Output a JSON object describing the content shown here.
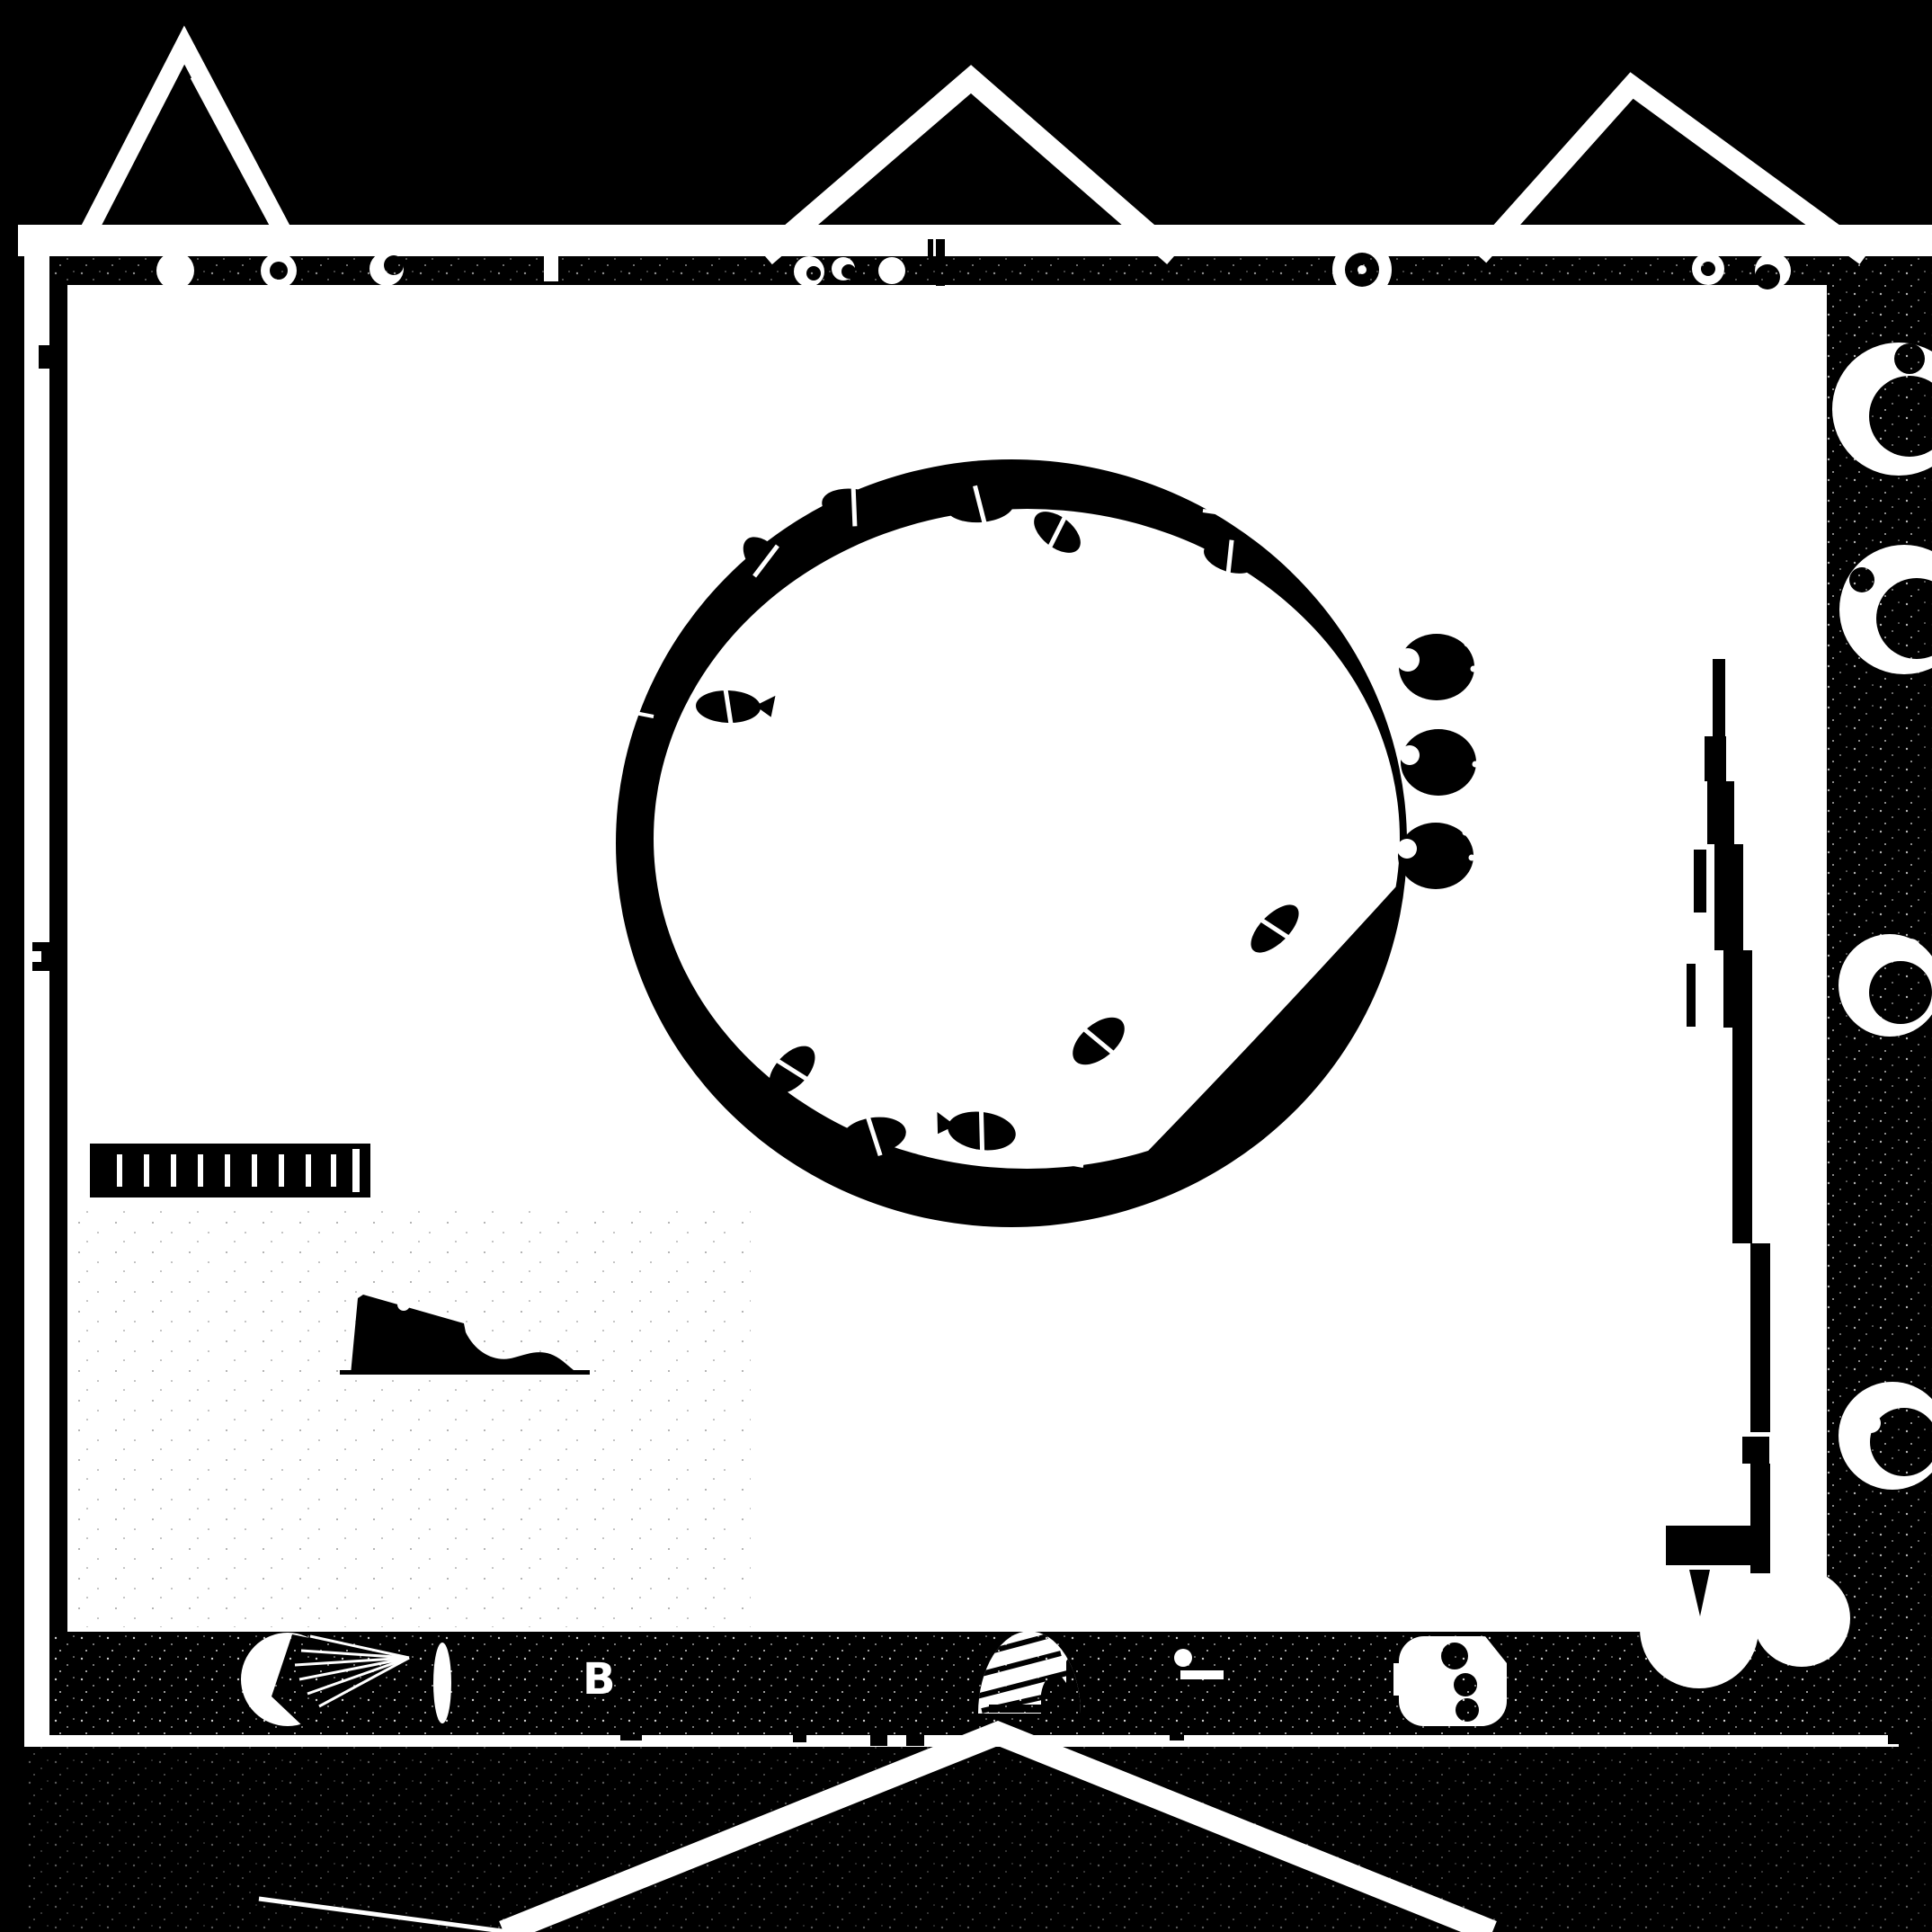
{
  "scene": {
    "description": "High-contrast black-and-white top-down plan of a walled garden scene: central round koi pond with fish, stepping-stone discs, plank bridge, stone ramp, stepped path, gate with seated figure, fan pavilion, dish stones along the right margin, three mountain gables above the frame and a V-shaped road leaving the bottom gate.",
    "colors": {
      "ink": "#000000",
      "paper": "#ffffff"
    },
    "bottom_wall": {
      "label": "B"
    },
    "counts": {
      "koi_fish": 11,
      "stepping_stone_discs": 3,
      "right_margin_dishes": 4,
      "bridge_planks": 10,
      "mountain_gables": 3,
      "top_wall_ornaments": 9,
      "stair_steps": 9,
      "pond_rim_joints": 5
    }
  }
}
